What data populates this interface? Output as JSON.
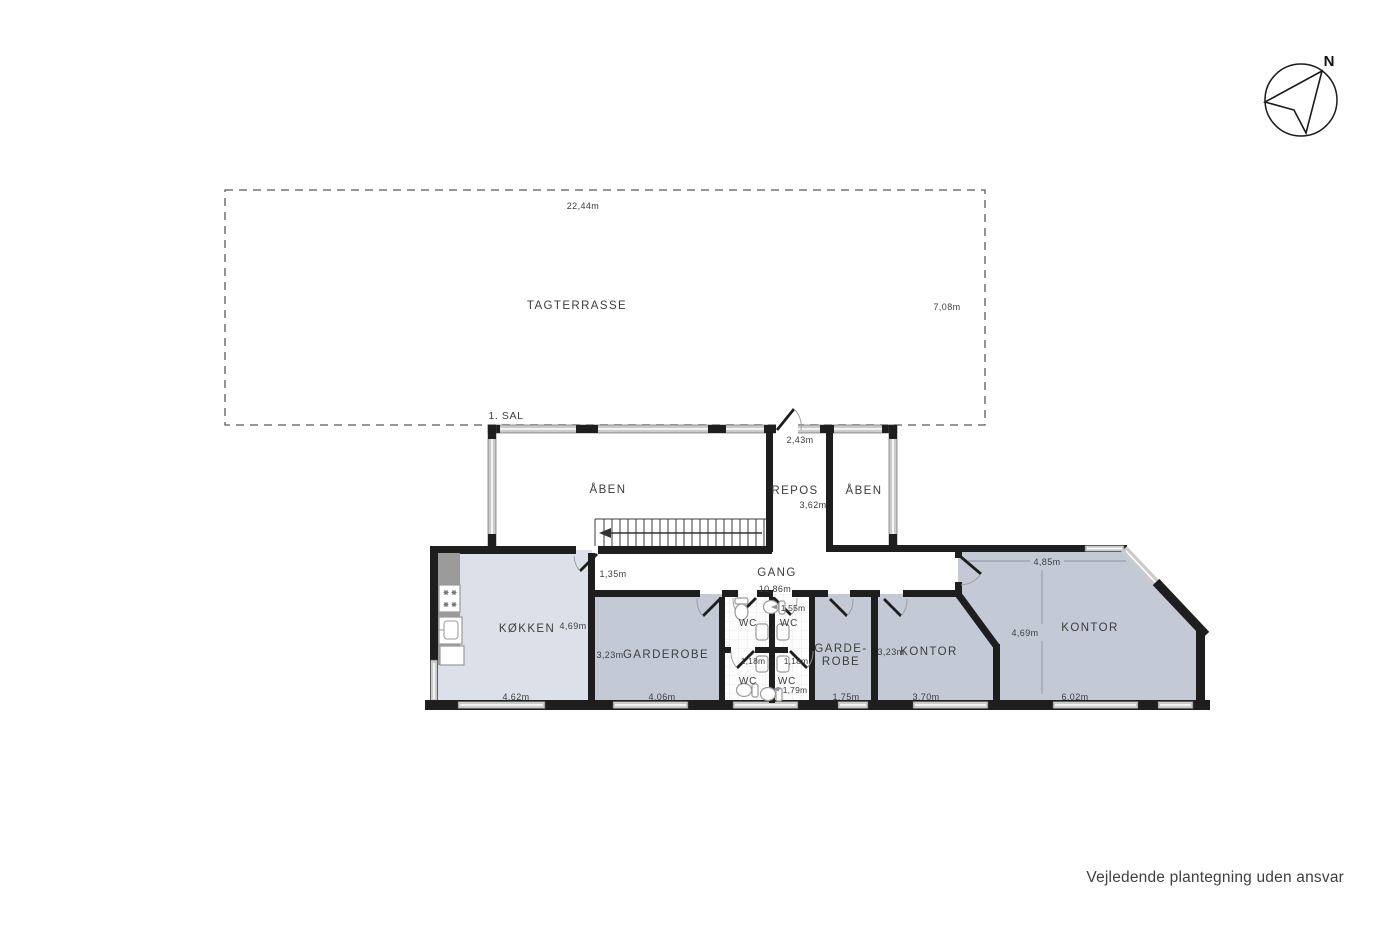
{
  "compass": {
    "north_label": "N"
  },
  "terrace": {
    "label": "TAGTERRASSE",
    "width": "22,44m",
    "depth": "7,08m"
  },
  "floor": {
    "label": "1. SAL"
  },
  "upper": {
    "aaben_left": "ÅBEN",
    "repos": "REPOS",
    "repos_door_width": "2,43m",
    "repos_depth": "3,62m",
    "aaben_right": "ÅBEN"
  },
  "corridor": {
    "label": "GANG",
    "length": "10,86m",
    "door_width": "1,35m"
  },
  "rooms": {
    "koekken": {
      "label": "KØKKEN",
      "depth": "4,69m",
      "width": "4,62m"
    },
    "garderobe": {
      "label": "GARDEROBE",
      "depth": "3,23m",
      "width": "4,06m"
    },
    "wc_top_left": {
      "label": "WC"
    },
    "wc_top_right": {
      "label": "WC",
      "width": "1,55m"
    },
    "wc_bottom_left": {
      "label": "WC",
      "width": "1,18m"
    },
    "wc_bottom_right": {
      "label": "WC",
      "width": "1,18m",
      "depth": "1,79m"
    },
    "garde_robe": {
      "label_line1": "GARDE-",
      "label_line2": "ROBE",
      "width": "1,75m"
    },
    "kontor_left": {
      "label": "KONTOR",
      "depth": "3,23m",
      "width": "3,70m"
    },
    "kontor_right": {
      "label": "KONTOR",
      "width_top": "4,85m",
      "depth": "4,69m",
      "width": "6,02m"
    }
  },
  "footer": {
    "disclaimer": "Vejledende plantegning uden ansvar"
  },
  "colors": {
    "wall": "#1e1e1e",
    "room_light": "#dce1e9",
    "room_medium": "#c3cad6",
    "window": "#cbcbcb",
    "tile_grid": "#e3e5ea"
  }
}
